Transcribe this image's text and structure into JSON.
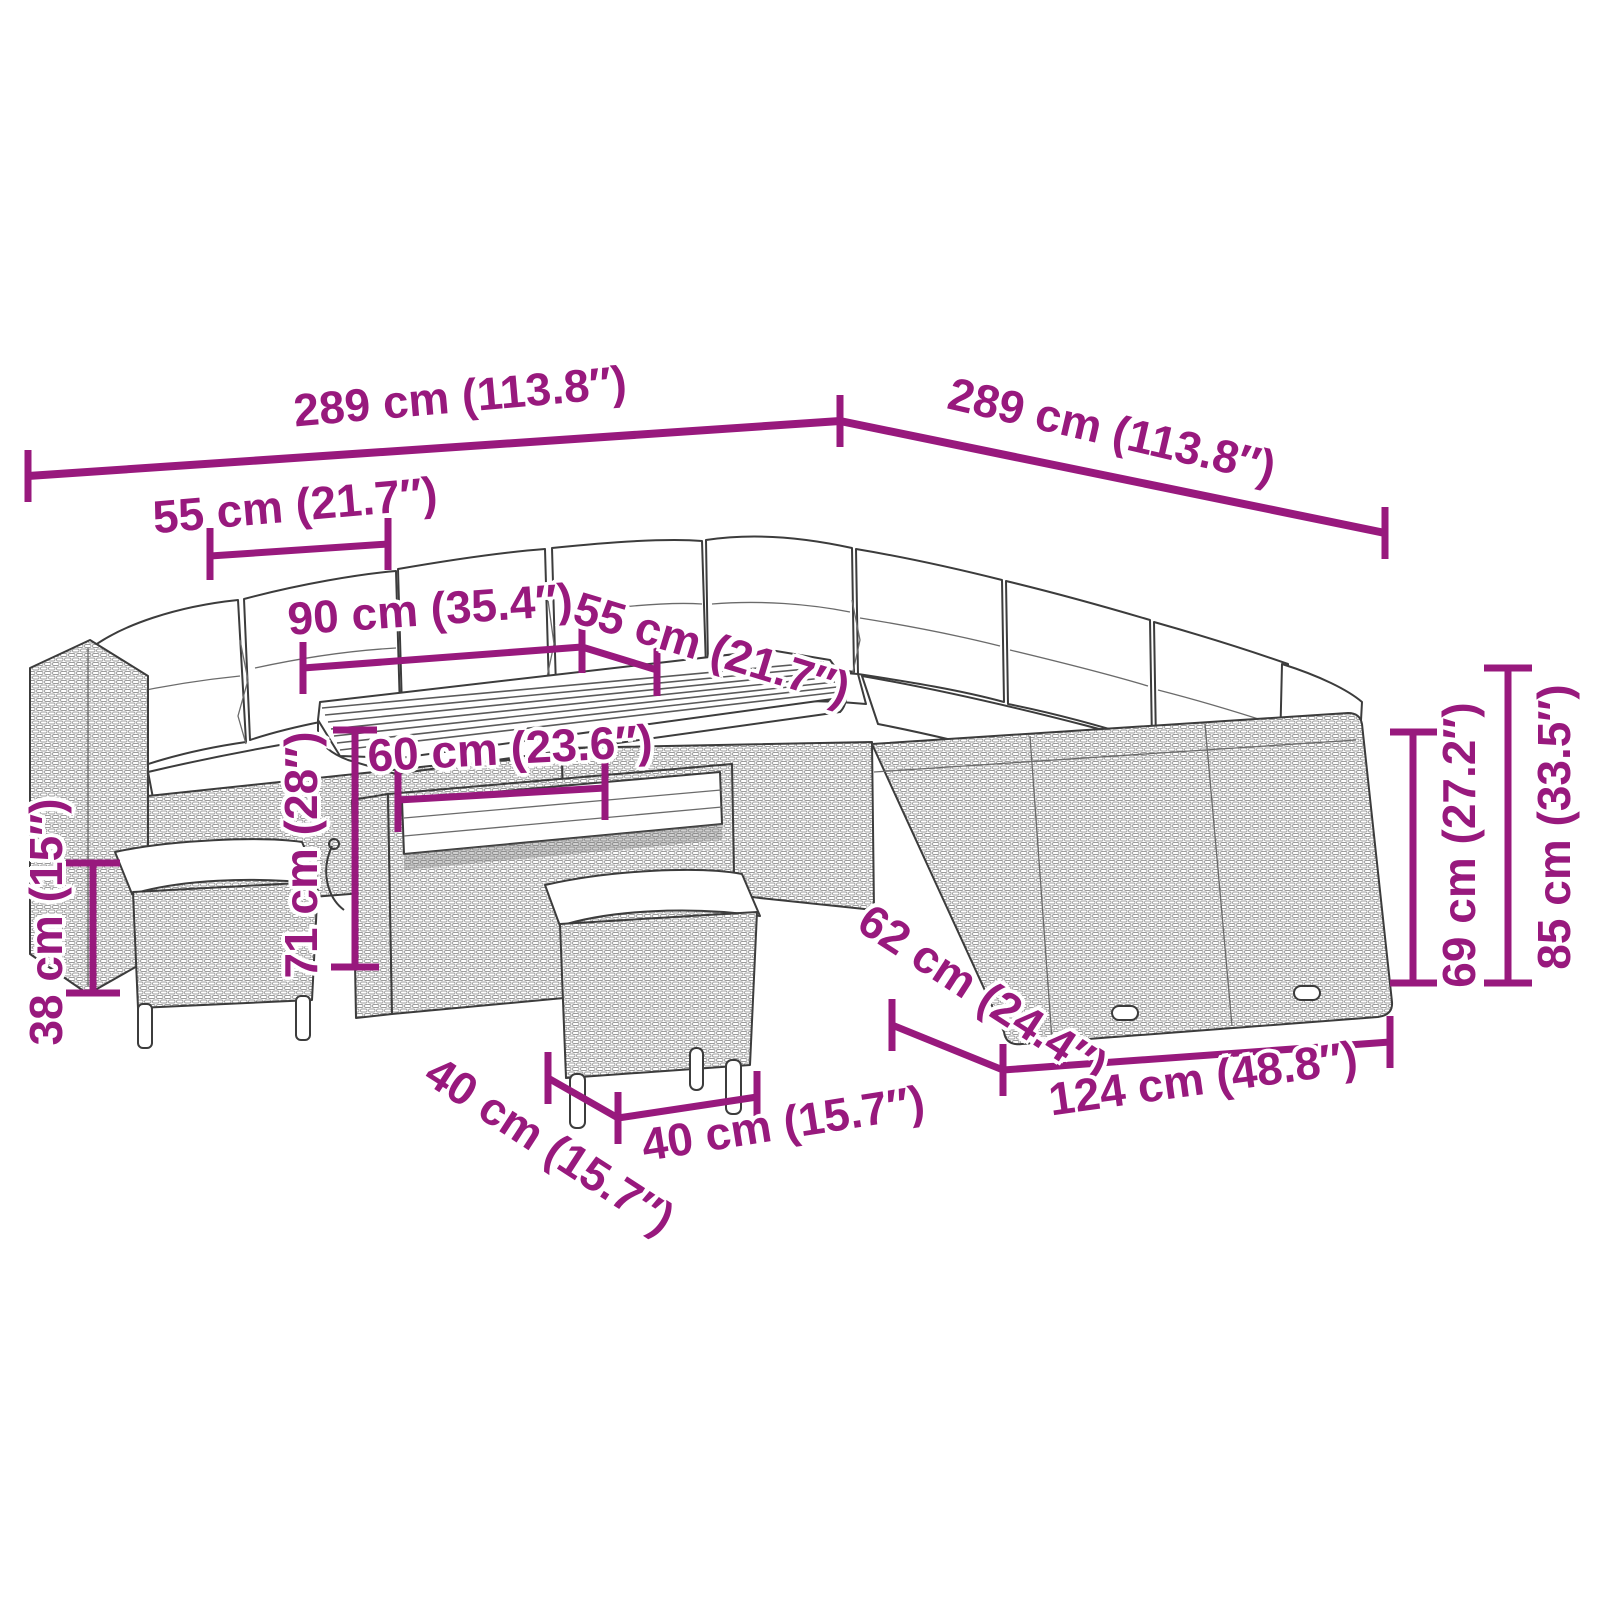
{
  "diagram": {
    "type": "product-dimension-diagram",
    "subject": "rattan-garden-lounge-set-with-table-and-stools",
    "background": "#ffffff"
  },
  "colors": {
    "dimension_accent": "#98197D",
    "drawing_line": "#3c3c3c"
  },
  "dimension_labels": {
    "total_width_left": "289 cm (113.8″)",
    "total_width_right": "289 cm (113.8″)",
    "module_width": "55 cm (21.7″)",
    "table_length": "90 cm (35.4″)",
    "seat_depth": "55 cm (21.7″)",
    "table_width": "60 cm (23.6″)",
    "table_height": "71 cm (28″)",
    "stool_height": "38 cm (15″)",
    "stool_depth": "40 cm (15.7″)",
    "stool_width": "40 cm (15.7″)",
    "sofa_depth": "62 cm (24.4″)",
    "sofa_width": "124 cm (48.8″)",
    "seat_back_height": "69 cm (27.2″)",
    "total_height": "85 cm (33.5″)"
  }
}
